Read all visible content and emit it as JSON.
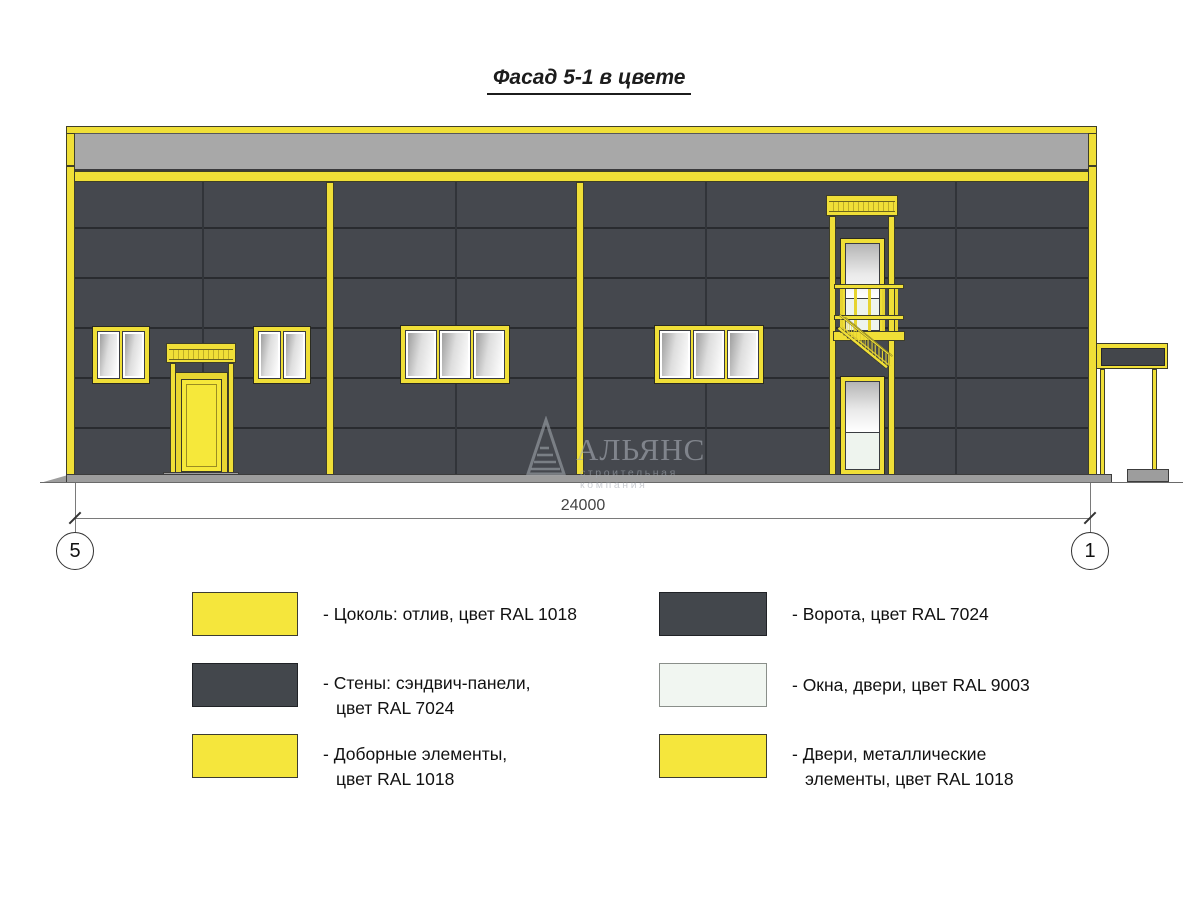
{
  "title": "Фасад 5-1 в цвете",
  "dimension": {
    "value": "24000"
  },
  "grid_markers": {
    "left": "5",
    "right": "1"
  },
  "watermark": {
    "name": "АЛЬЯНС",
    "tagline": "строительная компания"
  },
  "legend": {
    "left": [
      {
        "swatch_color": "#f5e63c",
        "lines": [
          "- Цоколь: отлив, цвет RAL 1018",
          ""
        ]
      },
      {
        "swatch_color": "#43474c",
        "lines": [
          "- Стены: сэндвич-панели,",
          "цвет RAL 7024"
        ]
      },
      {
        "swatch_color": "#f5e63c",
        "lines": [
          "- Доборные элементы,",
          "цвет RAL 1018"
        ]
      }
    ],
    "right": [
      {
        "swatch_color": "#43474c",
        "lines": [
          "- Ворота, цвет RAL 7024",
          ""
        ]
      },
      {
        "swatch_color": "#f1f6f1",
        "lines": [
          "- Окна, двери, цвет RAL 9003",
          ""
        ]
      },
      {
        "swatch_color": "#f5e63c",
        "lines": [
          "- Двери, металлические",
          "элементы, цвет RAL 1018"
        ]
      }
    ]
  },
  "colors": {
    "ral1018_yellow": "#f0df37",
    "ral7024_grey_walls": "#45484e",
    "ral9003_white_windows": "#f1f6f1",
    "parapet_grey_band": "#a8a8a8",
    "ground_grey": "#9d9d9d"
  }
}
